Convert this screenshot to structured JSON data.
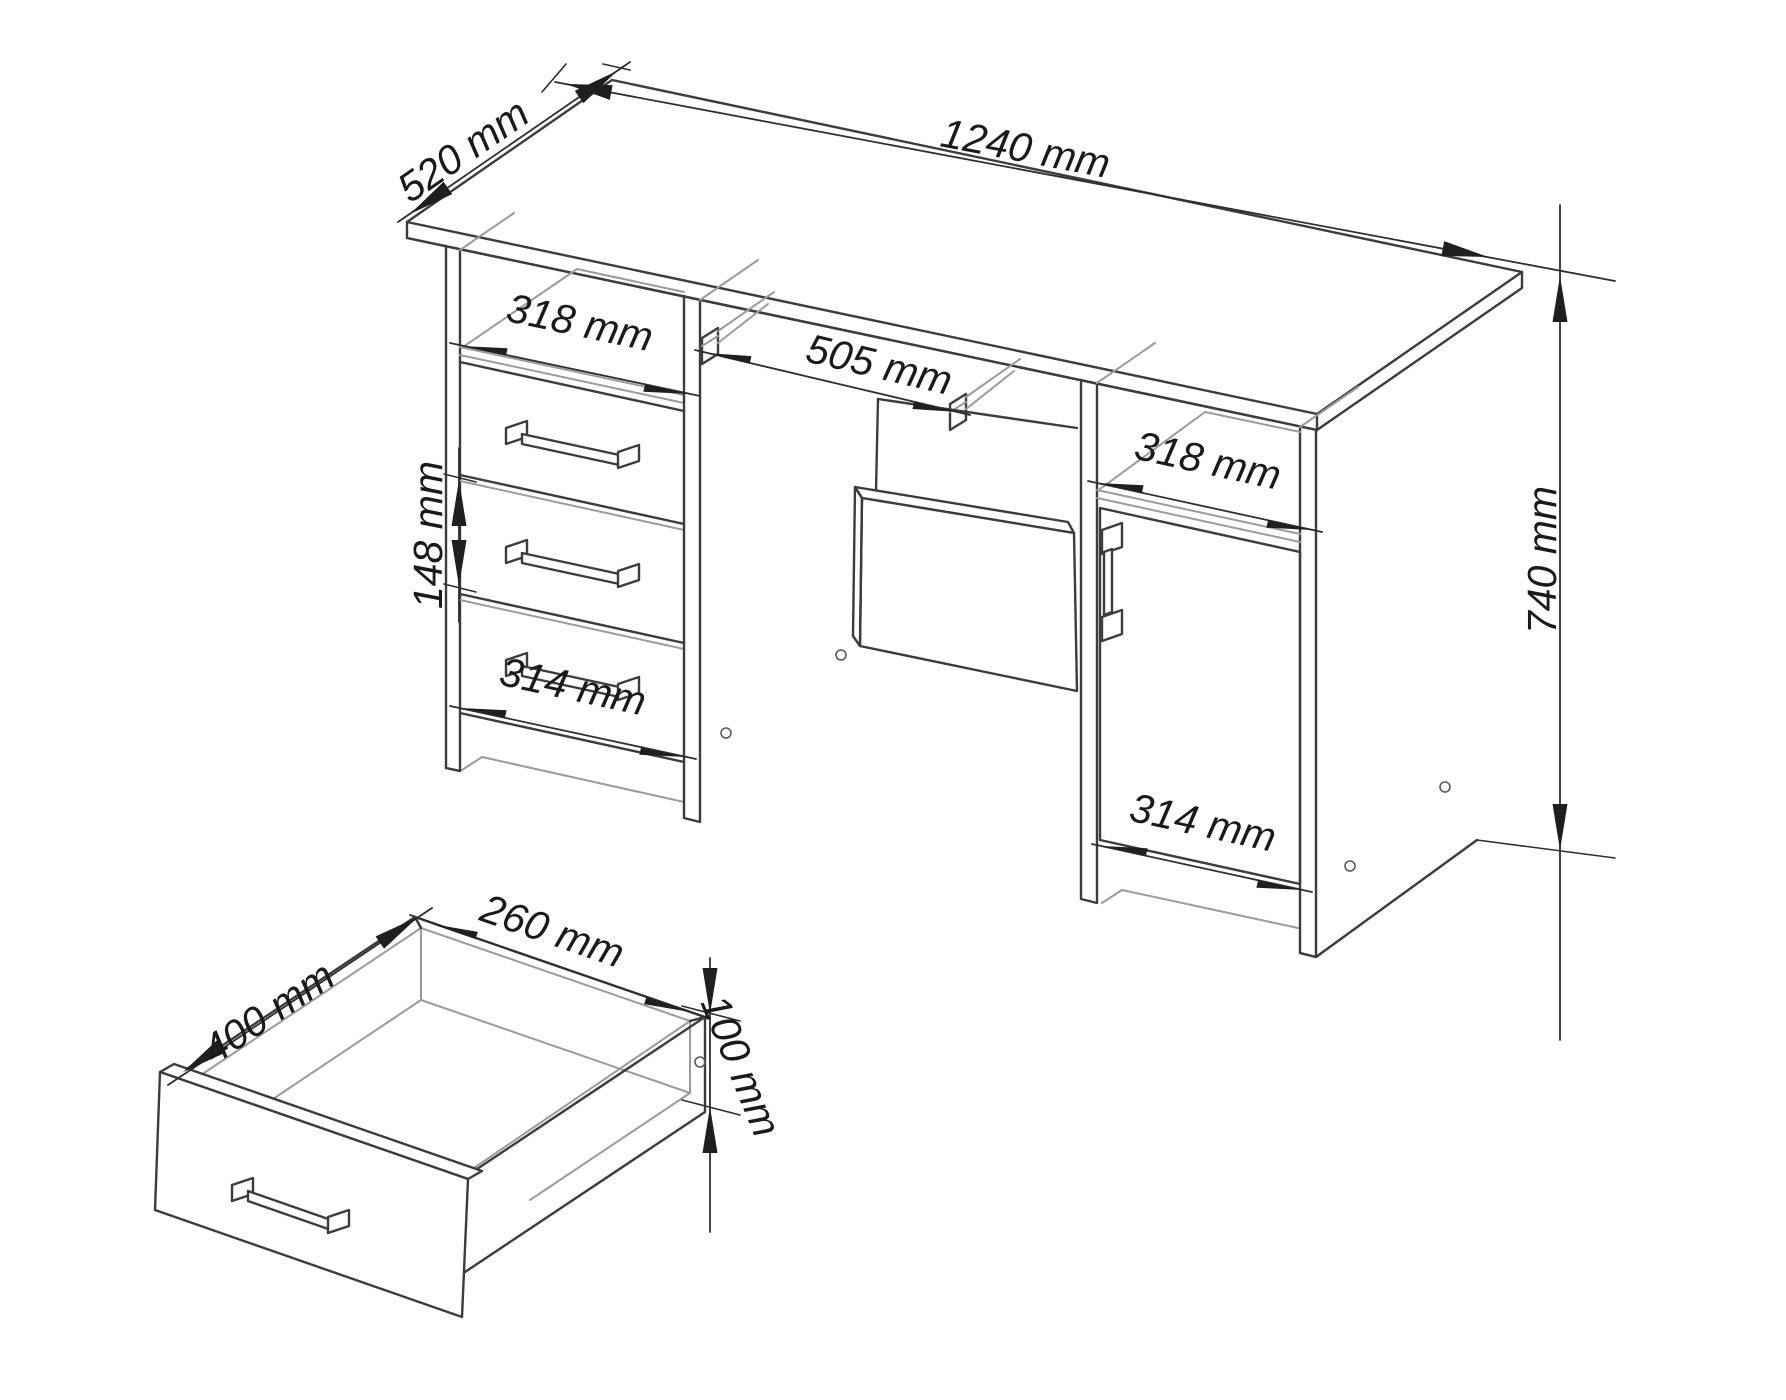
{
  "drawing": {
    "kind": "furniture-dimension-diagram",
    "units": "mm",
    "colors": {
      "background": "#ffffff",
      "line": "#3c3c3c",
      "secondary_line": "#9b9b9b",
      "dimension_text": "#1a1a1a"
    },
    "dims": {
      "desk_depth": "520 mm",
      "desk_width": "1240 mm",
      "desk_height": "740 mm",
      "left_niche_width": "318 mm",
      "tray_width": "505 mm",
      "drawer_front_height": "148 mm",
      "left_drawer_width": "314 mm",
      "right_niche_width": "318 mm",
      "right_door_width": "314 mm",
      "drawer_depth": "400 mm",
      "drawer_inner_width": "260 mm",
      "drawer_height": "100 mm"
    }
  }
}
